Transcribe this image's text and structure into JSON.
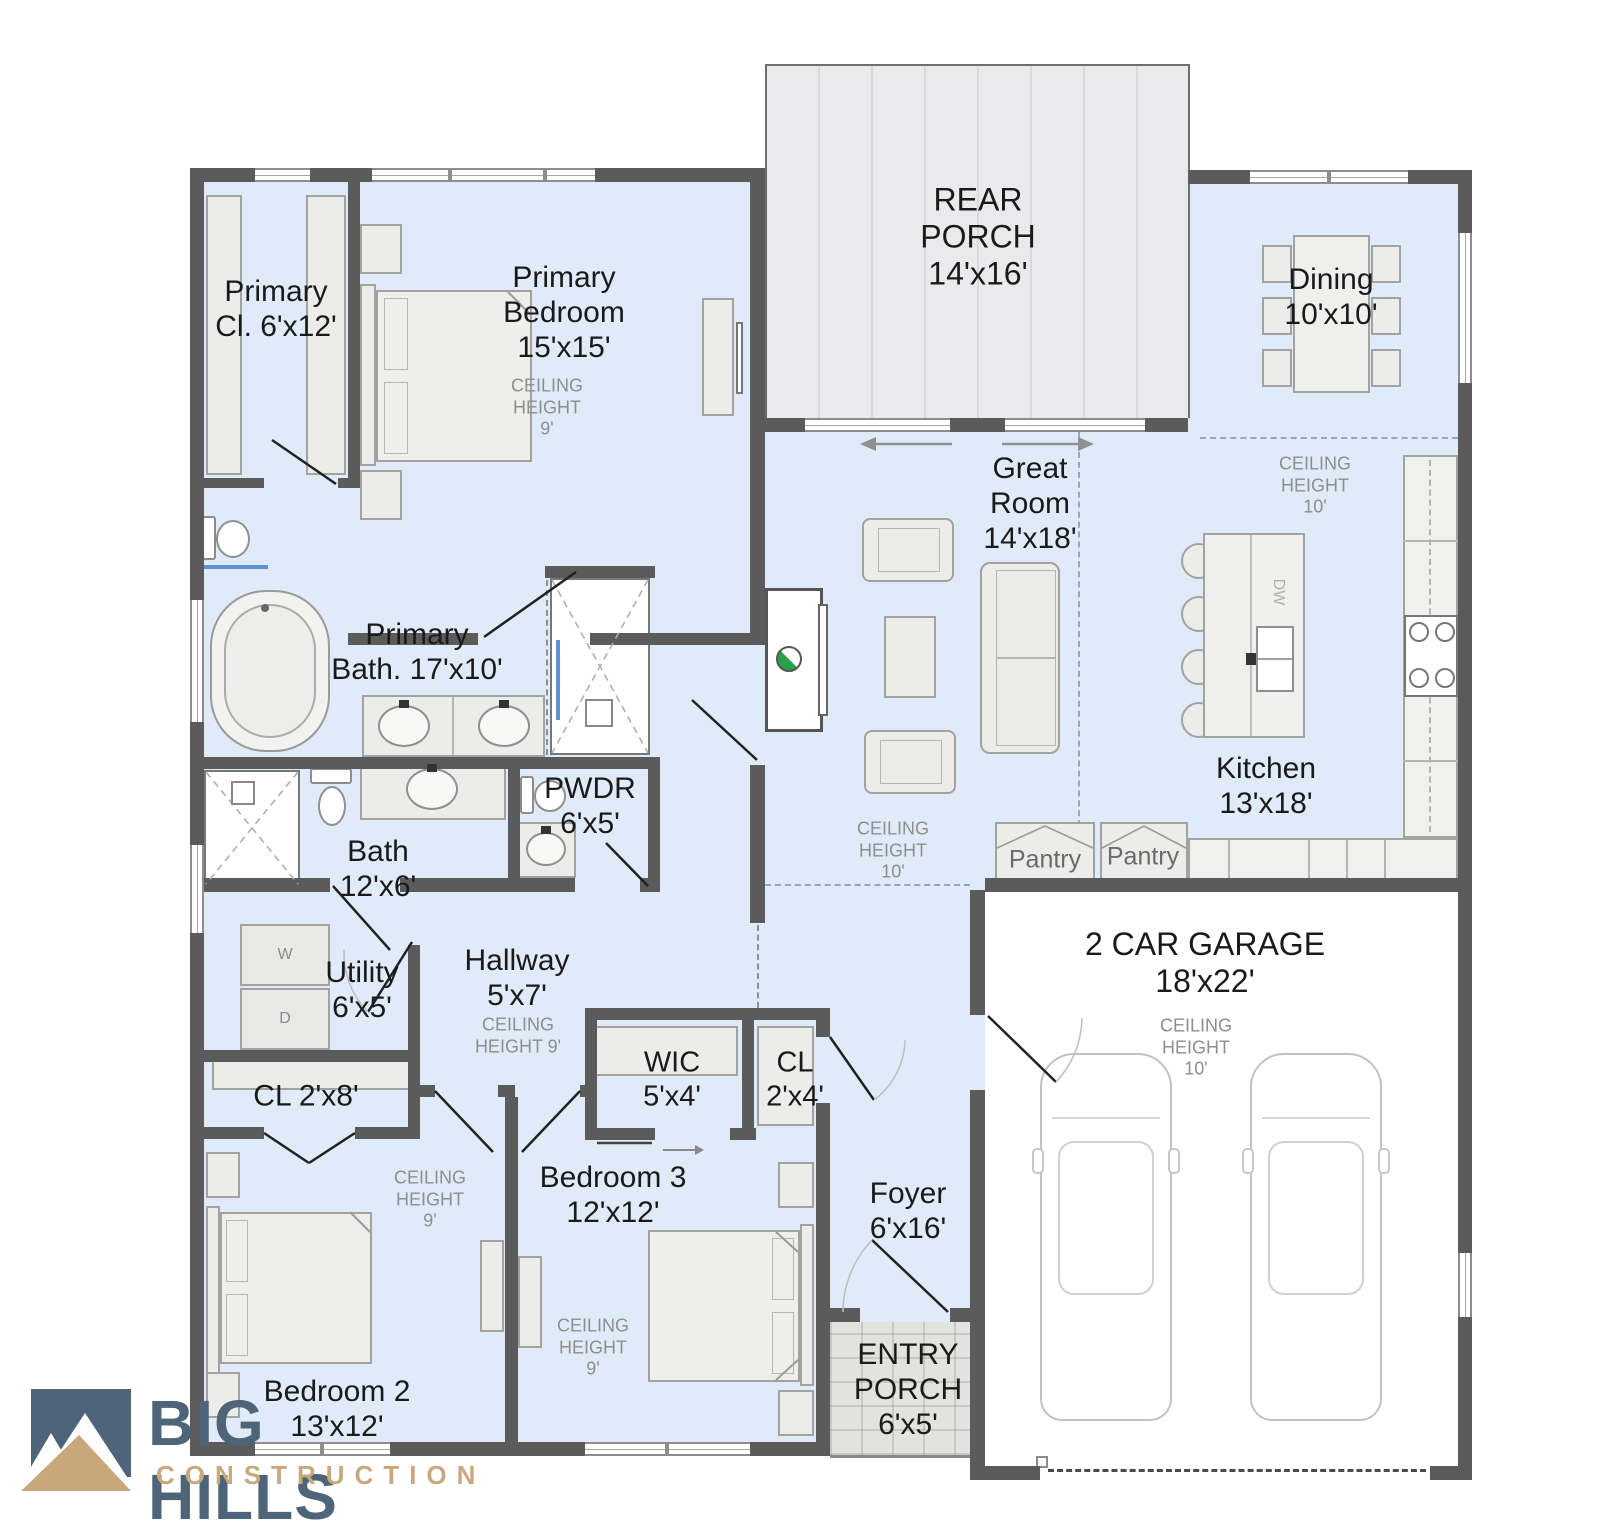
{
  "brand": {
    "name": "BIG HILLS",
    "tagline": "CONSTRUCTION",
    "logo_blue": "#4e6478",
    "logo_tan": "#c9a87d"
  },
  "colors": {
    "wall": "#5b5b5b",
    "floor": "#e0ebf9",
    "porch": "#eaeaec",
    "accent_blue": "#5f93d8",
    "fan_green": "#2aa04a"
  },
  "rooms": {
    "rear_porch": {
      "label": "REAR\nPORCH\n14'x16'"
    },
    "primary_closet": {
      "label": "Primary\nCl.  6'x12'"
    },
    "primary_bedroom": {
      "label": "Primary\nBedroom\n15'x15'",
      "ceiling": "CEILING\nHEIGHT\n9'"
    },
    "dining": {
      "label": "Dining\n10'x10'",
      "ceiling": "CEILING\nHEIGHT\n10'"
    },
    "great_room": {
      "label": "Great\nRoom\n14'x18'",
      "ceiling": "CEILING\nHEIGHT\n10'"
    },
    "kitchen": {
      "label": "Kitchen\n13'x18'",
      "dishwasher": "DW",
      "pantry1": "Pantry",
      "pantry2": "Pantry"
    },
    "primary_bath": {
      "label": "Primary\nBath. 17'x10'"
    },
    "powder": {
      "label": "PWDR\n6'x5'"
    },
    "bath": {
      "label": "Bath\n12'x6'"
    },
    "utility": {
      "label": "Utility\n6'x5'",
      "washer": "W",
      "dryer": "D"
    },
    "hallway": {
      "label": "Hallway\n5'x7'",
      "ceiling": "CEILING\nHEIGHT 9'"
    },
    "closet_hall": {
      "label": "CL  2'x8'"
    },
    "wic": {
      "label": "WIC\n5'x4'"
    },
    "closet_foyer": {
      "label": "CL\n2'x4'"
    },
    "bedroom3": {
      "label": "Bedroom 3\n12'x12'",
      "ceiling": "CEILING\nHEIGHT\n9'"
    },
    "bedroom2": {
      "label": "Bedroom 2\n13'x12'",
      "ceiling": "CEILING\nHEIGHT\n9'"
    },
    "foyer": {
      "label": "Foyer\n6'x16'"
    },
    "entry_porch": {
      "label": "ENTRY\nPORCH\n6'x5'"
    },
    "garage": {
      "label": "2 CAR GARAGE\n18'x22'",
      "ceiling": "CEILING\nHEIGHT\n10'"
    }
  }
}
